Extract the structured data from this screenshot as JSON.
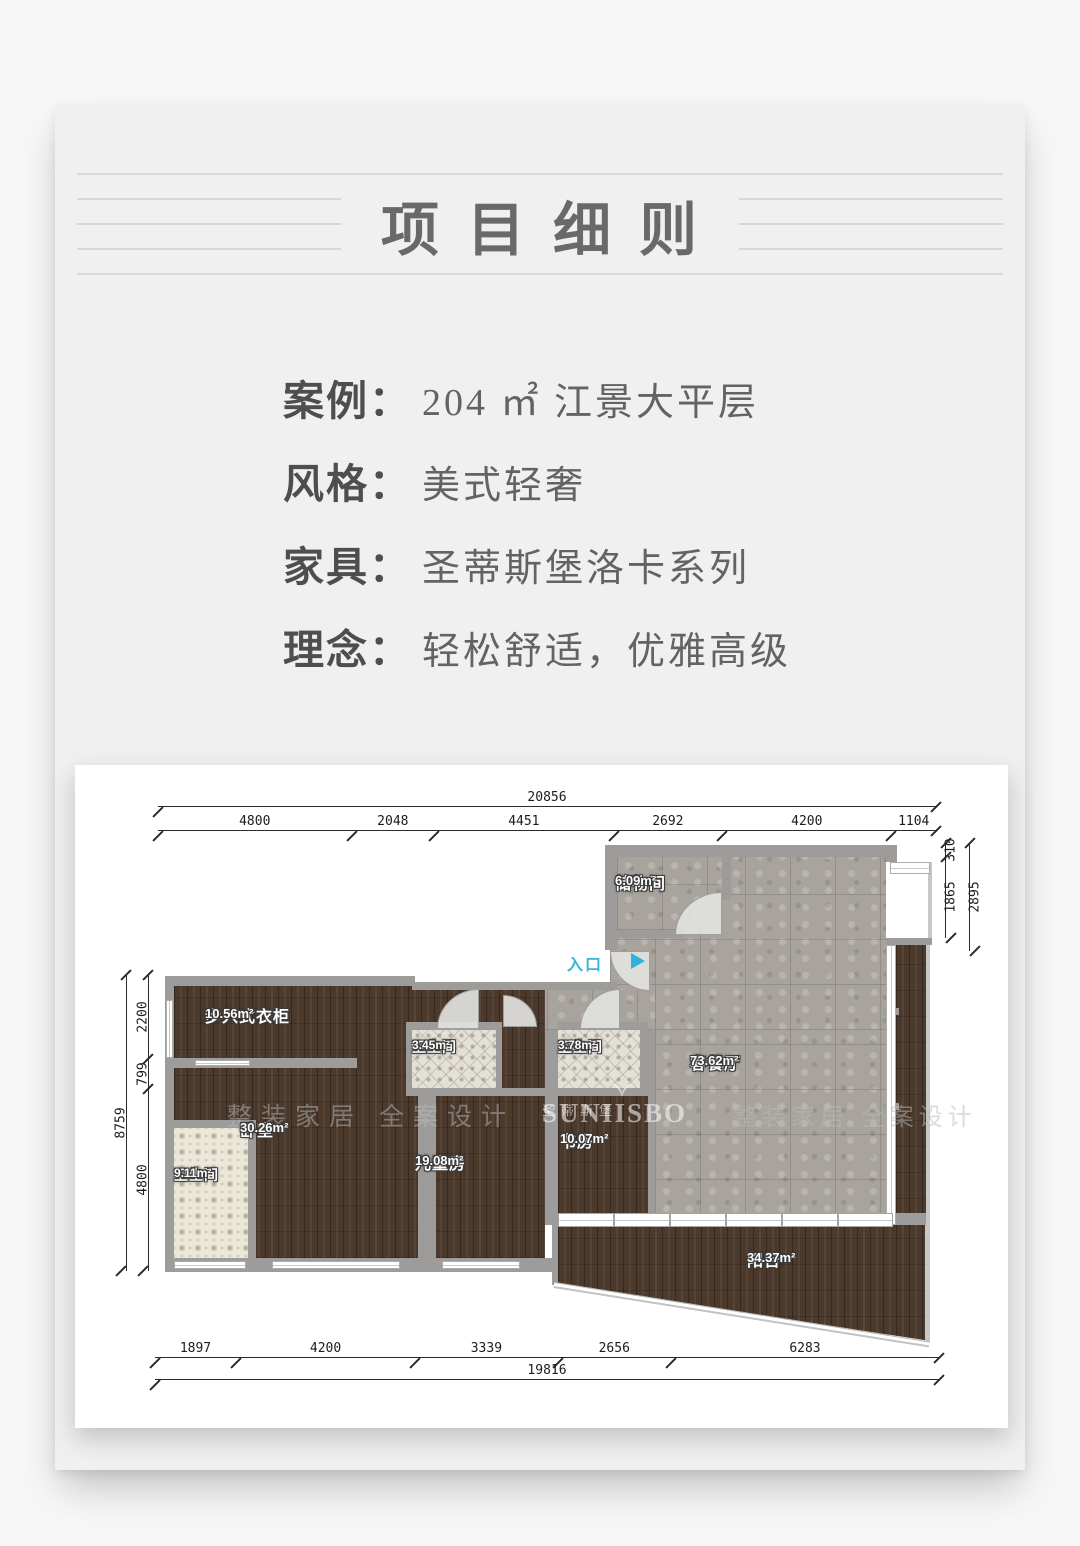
{
  "title": {
    "text": "项目细则"
  },
  "info": {
    "rows": [
      {
        "label": "案例：",
        "value": "204 ㎡ 江景大平层"
      },
      {
        "label": "风格：",
        "value": "美式轻奢"
      },
      {
        "label": "家具：",
        "value": "圣蒂斯堡洛卡系列"
      },
      {
        "label": "理念：",
        "value": "轻松舒适，优雅高级"
      }
    ]
  },
  "plan": {
    "entrance": {
      "label": "入口"
    },
    "rooms": {
      "storage": {
        "name": "储物间",
        "area": "6.09m²"
      },
      "living": {
        "name": "客餐厅",
        "area": "73.62m²"
      },
      "closet": {
        "name": "步入式衣柜",
        "area": "10.56m²"
      },
      "bath_345": {
        "name": "卫生间",
        "area": "3.45m²"
      },
      "bath_378": {
        "name": "卫生间",
        "area": "3.78m²"
      },
      "bedroom": {
        "name": "卧室",
        "area": "30.26m²"
      },
      "kids_room": {
        "name": "儿童房",
        "area": "19.08m²"
      },
      "study": {
        "name": "书房",
        "area": "10.07m²"
      },
      "bath_911": {
        "name": "卫生间",
        "area": "9.11m²"
      },
      "balcony": {
        "name": "阳台",
        "area": "34.37m²"
      }
    },
    "dims": {
      "top_total": "20856",
      "top": [
        "4800",
        "2048",
        "4451",
        "2692",
        "4200",
        "1104"
      ],
      "right": [
        "310",
        "1865"
      ],
      "right_total": "2895",
      "left_total": "8759",
      "left": [
        "2200",
        "799",
        "4800"
      ],
      "bottom": [
        "1897",
        "4200",
        "3339",
        "2656",
        "6283"
      ],
      "bottom_total": "19816"
    },
    "watermark": {
      "text": "整装家居 全案设计",
      "brand_en": "SUNIISBO",
      "brand_cn": "圣蒂斯堡"
    }
  },
  "colors": {
    "card_bg": "#f0f0f1",
    "wall_gray": "#9d9c9a",
    "wood_floor": "#4b392c",
    "stone_floor": "#a8a39d",
    "entrance_blue": "#2fb4d9"
  }
}
